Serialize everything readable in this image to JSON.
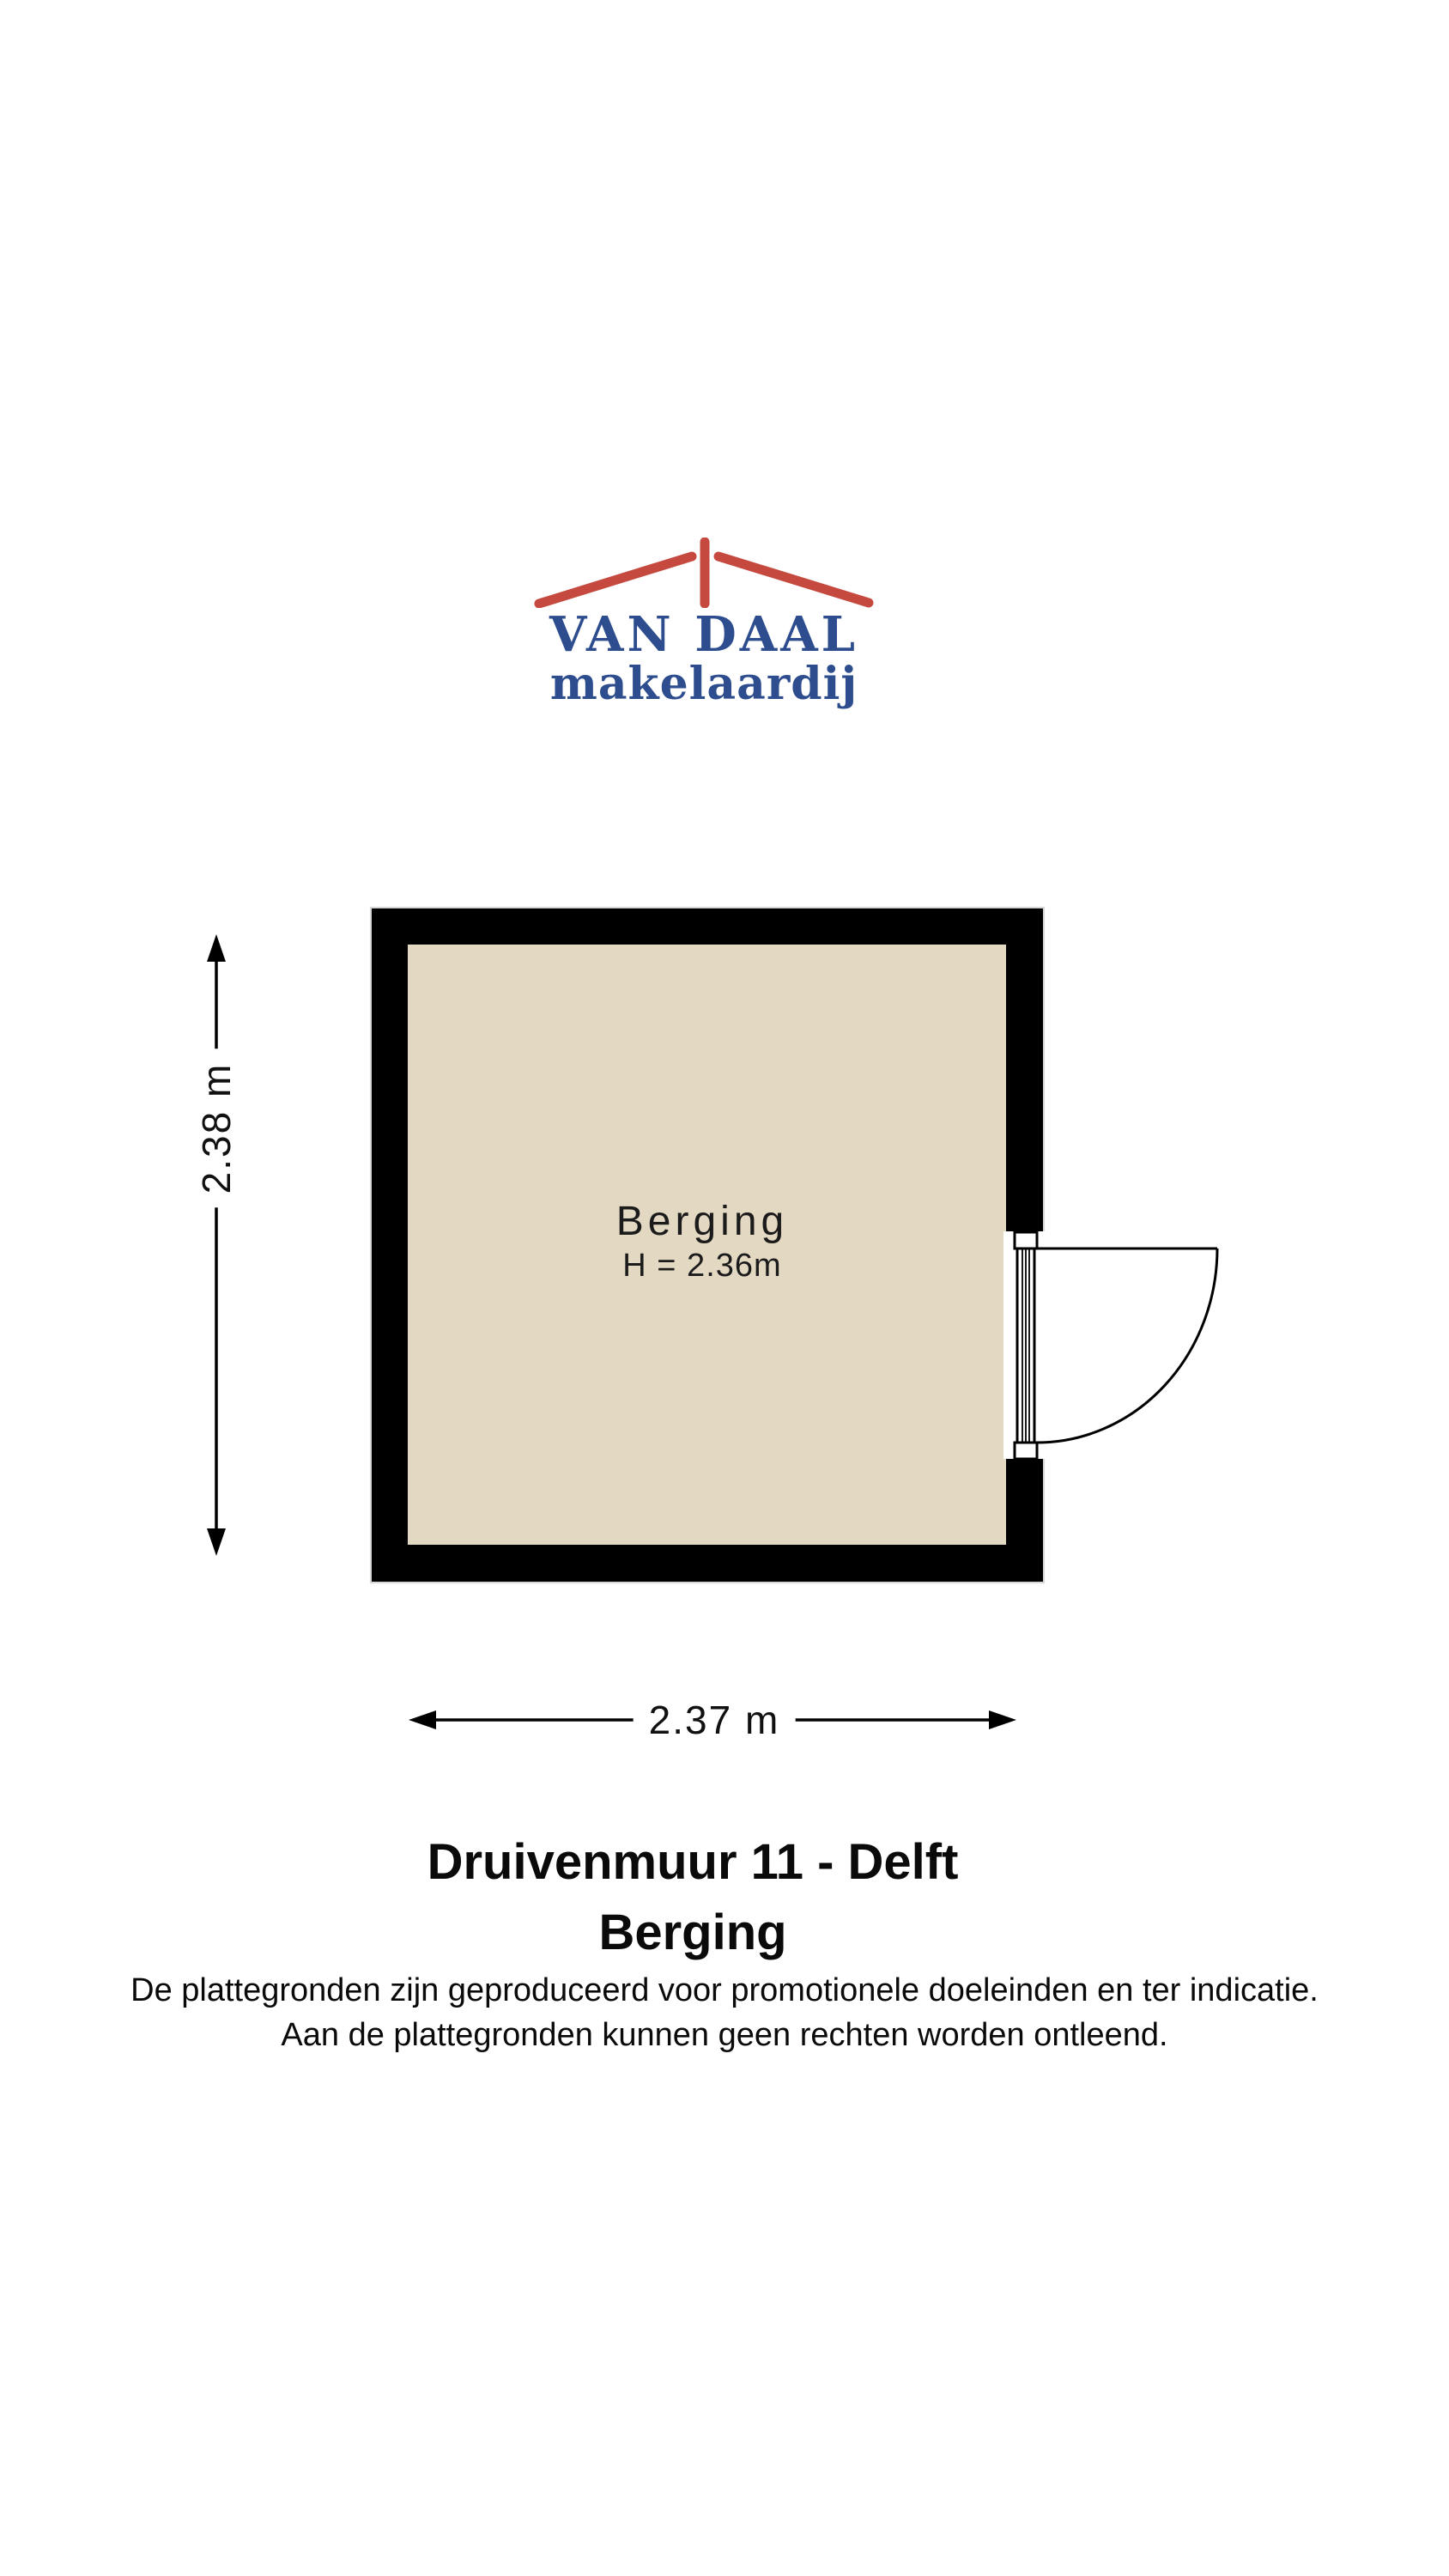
{
  "logo": {
    "name": "VAN DAAL",
    "subtitle": "makelaardij",
    "roof_color": "#c6493f",
    "text_color": "#2d4d8e"
  },
  "floor_plan": {
    "room": {
      "name": "Berging",
      "ceiling_height": "H = 2.36m"
    },
    "dimensions": {
      "width": "2.37 m",
      "height": "2.38 m"
    },
    "wall_color": "#000000",
    "floor_color": "#e3d8c2",
    "line_color": "#000000"
  },
  "caption": {
    "address": "Druivenmuur 11 - Delft",
    "room": "Berging"
  },
  "disclaimer": {
    "line1": "De plattegronden zijn geproduceerd voor promotionele doeleinden en ter indicatie.",
    "line2": "Aan de plattegronden kunnen geen rechten worden ontleend."
  }
}
